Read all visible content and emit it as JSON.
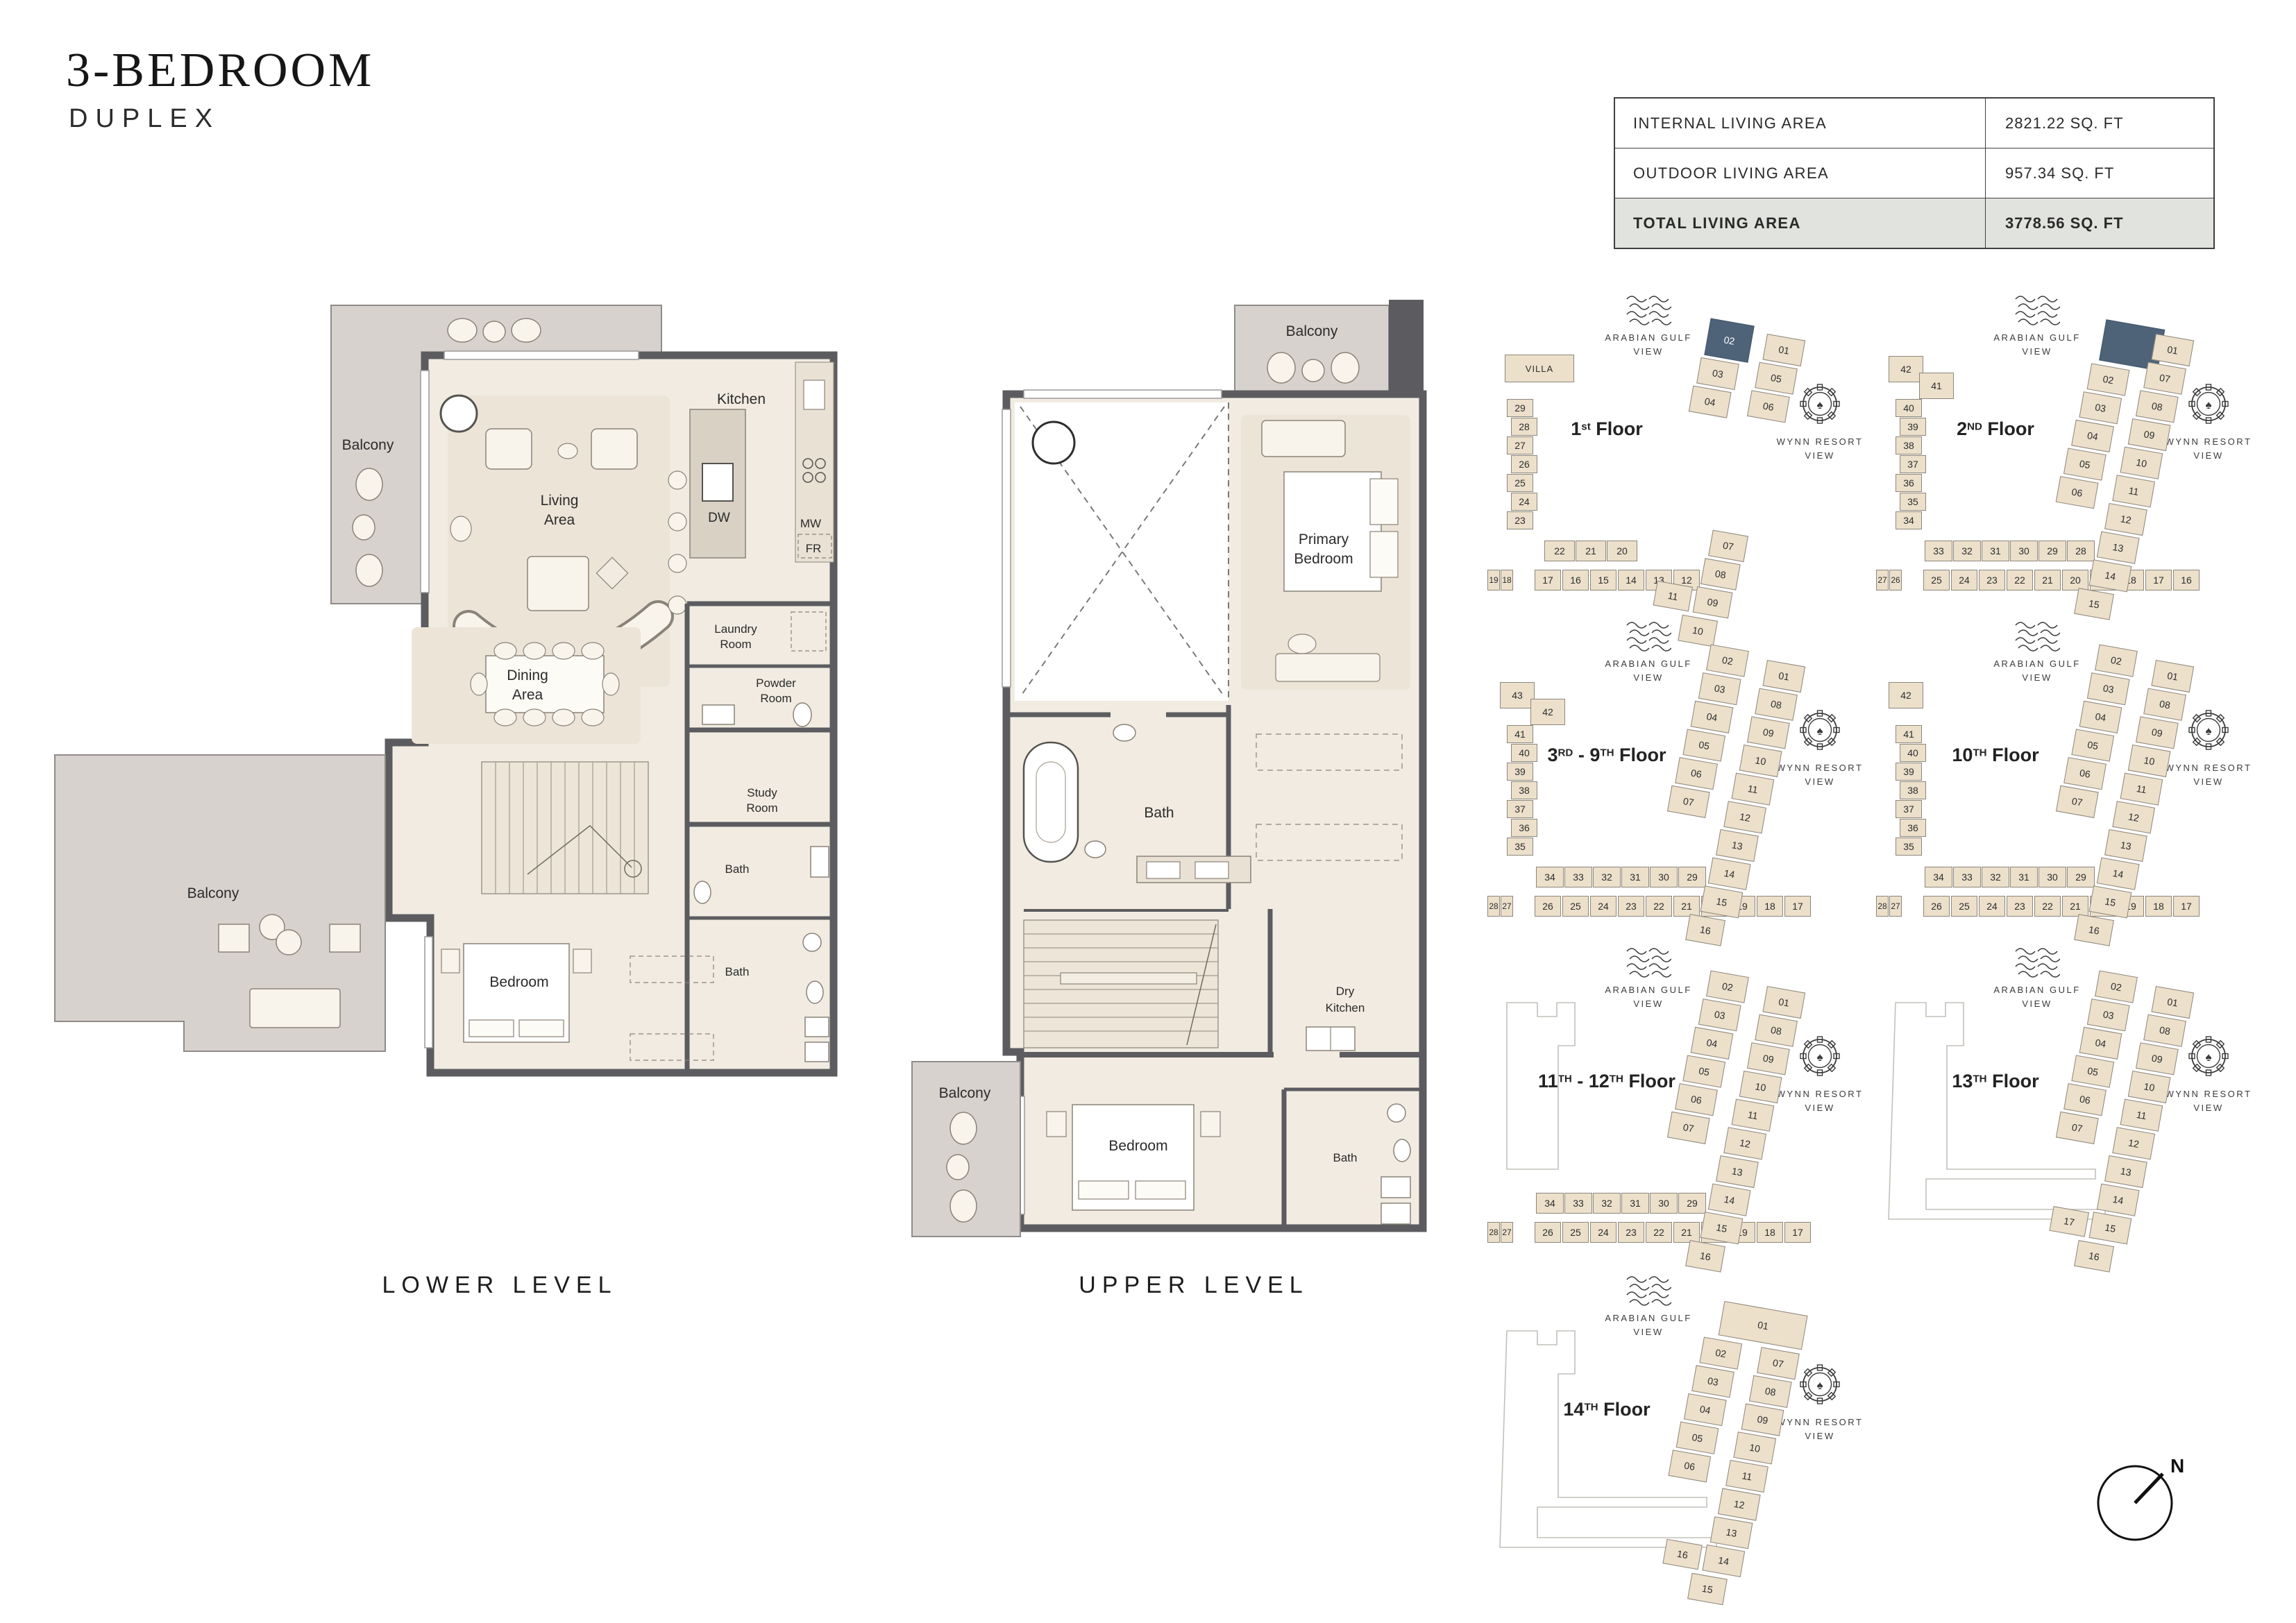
{
  "header": {
    "title": "3-BEDROOM",
    "subtitle": "DUPLEX"
  },
  "area_table": {
    "rows": [
      {
        "label": "INTERNAL LIVING AREA",
        "value": "2821.22 SQ. FT"
      },
      {
        "label": "OUTDOOR LIVING AREA",
        "value": "957.34 SQ. FT"
      },
      {
        "label": "TOTAL LIVING AREA",
        "value": "3778.56 SQ. FT"
      }
    ]
  },
  "lower_level": {
    "caption": "LOWER LEVEL",
    "labels": {
      "balcony_top": "Balcony",
      "living": [
        "Living",
        "Area"
      ],
      "kitchen": "Kitchen",
      "dw": "DW",
      "mw": "MW",
      "fr": "FR",
      "laundry": [
        "Laundry",
        "Room"
      ],
      "powder": [
        "Powder",
        "Room"
      ],
      "dining": [
        "Dining",
        "Area"
      ],
      "study": [
        "Study",
        "Room"
      ],
      "bath_upper": "Bath",
      "bath_lower": "Bath",
      "bedroom": "Bedroom",
      "balcony_bottom": "Balcony"
    }
  },
  "upper_level": {
    "caption": "UPPER LEVEL",
    "labels": {
      "balcony_top": "Balcony",
      "primary_bedroom": [
        "Primary",
        "Bedroom"
      ],
      "bath_main": "Bath",
      "dry_kitchen": [
        "Dry",
        "Kitchen"
      ],
      "bedroom": "Bedroom",
      "bath_small": "Bath",
      "balcony_left": "Balcony"
    }
  },
  "views": {
    "gulf": [
      "ARABIAN GULF",
      "VIEW"
    ],
    "wynn": [
      "WYNN RESORT",
      "VIEW"
    ]
  },
  "compass": {
    "label": "N"
  },
  "colors": {
    "highlight": "#4e6378",
    "unit_fill": "#ece0cb",
    "wall": "#5c5c60",
    "balcony": "#d8d2cf",
    "total_row_bg": "#e1e3de"
  },
  "keyplans": [
    {
      "id": "1st-floor",
      "title": [
        {
          "t": "1"
        },
        {
          "t": "st",
          "sup": true
        },
        {
          "t": " Floor"
        }
      ],
      "villa": "VILLA",
      "top_blocks": [],
      "left_units": [
        "29",
        "28",
        "27",
        "26",
        "25",
        "24",
        "23"
      ],
      "mid_units": [
        "22",
        "21",
        "20"
      ],
      "bottom_pair": [
        "19",
        "18"
      ],
      "bottom_units": [
        "17",
        "16",
        "15",
        "14",
        "13",
        "12"
      ],
      "outline": "none",
      "cluster": {
        "left_chain": [
          {
            "n": "02",
            "hl": true
          },
          {
            "n": "03"
          },
          {
            "n": "04"
          }
        ],
        "right_chain": [
          "01",
          "05",
          "06"
        ],
        "lower_block": [
          "07",
          "08",
          "09"
        ],
        "side": "11",
        "tail": "10"
      }
    },
    {
      "id": "2nd-floor",
      "title": [
        {
          "t": "2"
        },
        {
          "t": "ND",
          "sup": true
        },
        {
          "t": " Floor"
        }
      ],
      "top_blocks": [
        "42",
        "41"
      ],
      "left_units": [
        "40",
        "39",
        "38",
        "37",
        "36",
        "35",
        "34"
      ],
      "mid_units": [
        "33",
        "32",
        "31",
        "30",
        "29",
        "28"
      ],
      "bottom_pair": [
        "27",
        "26"
      ],
      "bottom_units": [
        "25",
        "24",
        "23",
        "22",
        "21",
        "20",
        "19",
        "18",
        "17",
        "16"
      ],
      "outline": "none",
      "cluster": {
        "top_highlight": true,
        "left_chain": [
          {
            "n": "02"
          },
          {
            "n": "03"
          },
          {
            "n": "04"
          },
          {
            "n": "05"
          },
          {
            "n": "06"
          }
        ],
        "right_chain": [
          "01",
          "07",
          "08",
          "09",
          "10",
          "11",
          "12",
          "13",
          "14"
        ],
        "tail": "15"
      }
    },
    {
      "id": "3rd-9th-floor",
      "title": [
        {
          "t": "3"
        },
        {
          "t": "RD",
          "sup": true
        },
        {
          "t": " - 9"
        },
        {
          "t": "TH",
          "sup": true
        },
        {
          "t": " Floor"
        }
      ],
      "top_blocks": [
        "43",
        "42"
      ],
      "left_units": [
        "41",
        "40",
        "39",
        "38",
        "37",
        "36",
        "35"
      ],
      "mid_units": [
        "34",
        "33",
        "32",
        "31",
        "30",
        "29"
      ],
      "bottom_pair": [
        "28",
        "27"
      ],
      "bottom_units": [
        "26",
        "25",
        "24",
        "23",
        "22",
        "21",
        "20",
        "19",
        "18",
        "17"
      ],
      "outline": "none",
      "cluster": {
        "left_chain": [
          {
            "n": "02"
          },
          {
            "n": "03"
          },
          {
            "n": "04"
          },
          {
            "n": "05"
          },
          {
            "n": "06"
          },
          {
            "n": "07"
          }
        ],
        "right_chain": [
          "01",
          "08",
          "09",
          "10",
          "11",
          "12",
          "13",
          "14",
          "15"
        ],
        "tail": "16"
      }
    },
    {
      "id": "10th-floor",
      "title": [
        {
          "t": "10"
        },
        {
          "t": "TH",
          "sup": true
        },
        {
          "t": " Floor"
        }
      ],
      "top_blocks": [
        "42"
      ],
      "left_units": [
        "41",
        "40",
        "39",
        "38",
        "37",
        "36",
        "35"
      ],
      "mid_units": [
        "34",
        "33",
        "32",
        "31",
        "30",
        "29"
      ],
      "bottom_pair": [
        "28",
        "27"
      ],
      "bottom_units": [
        "26",
        "25",
        "24",
        "23",
        "22",
        "21",
        "20",
        "19",
        "18",
        "17"
      ],
      "outline": "none",
      "cluster": {
        "left_chain": [
          {
            "n": "02"
          },
          {
            "n": "03"
          },
          {
            "n": "04"
          },
          {
            "n": "05"
          },
          {
            "n": "06"
          },
          {
            "n": "07"
          }
        ],
        "right_chain": [
          "01",
          "08",
          "09",
          "10",
          "11",
          "12",
          "13",
          "14",
          "15"
        ],
        "tail": "16"
      }
    },
    {
      "id": "11th-12th-floor",
      "title": [
        {
          "t": "11"
        },
        {
          "t": "TH",
          "sup": true
        },
        {
          "t": " - 12"
        },
        {
          "t": "TH",
          "sup": true
        },
        {
          "t": " Floor"
        }
      ],
      "top_blocks": [],
      "left_units": [],
      "mid_units": [
        "34",
        "33",
        "32",
        "31",
        "30",
        "29"
      ],
      "bottom_pair": [
        "28",
        "27"
      ],
      "bottom_units": [
        "26",
        "25",
        "24",
        "23",
        "22",
        "21",
        "20",
        "19",
        "18",
        "17"
      ],
      "outline": "partial",
      "cluster": {
        "left_chain": [
          {
            "n": "02"
          },
          {
            "n": "03"
          },
          {
            "n": "04"
          },
          {
            "n": "05"
          },
          {
            "n": "06"
          },
          {
            "n": "07"
          }
        ],
        "right_chain": [
          "01",
          "08",
          "09",
          "10",
          "11",
          "12",
          "13",
          "14",
          "15"
        ],
        "tail": "16"
      }
    },
    {
      "id": "13th-floor",
      "title": [
        {
          "t": "13"
        },
        {
          "t": "TH",
          "sup": true
        },
        {
          "t": " Floor"
        }
      ],
      "top_blocks": [],
      "left_units": [],
      "mid_units": [],
      "bottom_pair": [],
      "bottom_units": [],
      "outline": "full",
      "cluster": {
        "left_chain": [
          {
            "n": "02"
          },
          {
            "n": "03"
          },
          {
            "n": "04"
          },
          {
            "n": "05"
          },
          {
            "n": "06"
          },
          {
            "n": "07"
          }
        ],
        "right_chain": [
          "01",
          "08",
          "09",
          "10",
          "11",
          "12",
          "13",
          "14",
          "15"
        ],
        "side": "17",
        "tail": "16"
      }
    },
    {
      "id": "14th-floor",
      "title": [
        {
          "t": "14"
        },
        {
          "t": "TH",
          "sup": true
        },
        {
          "t": " Floor"
        }
      ],
      "top_blocks": [],
      "left_units": [],
      "mid_units": [],
      "bottom_pair": [],
      "bottom_units": [],
      "outline": "full",
      "cluster": {
        "top_wide": "01",
        "left_chain": [
          {
            "n": "02"
          },
          {
            "n": "03"
          },
          {
            "n": "04"
          },
          {
            "n": "05"
          },
          {
            "n": "06"
          }
        ],
        "right_chain": [
          "07",
          "08",
          "09",
          "10",
          "11",
          "12",
          "13",
          "14"
        ],
        "side": "16",
        "tail": "15"
      }
    }
  ]
}
